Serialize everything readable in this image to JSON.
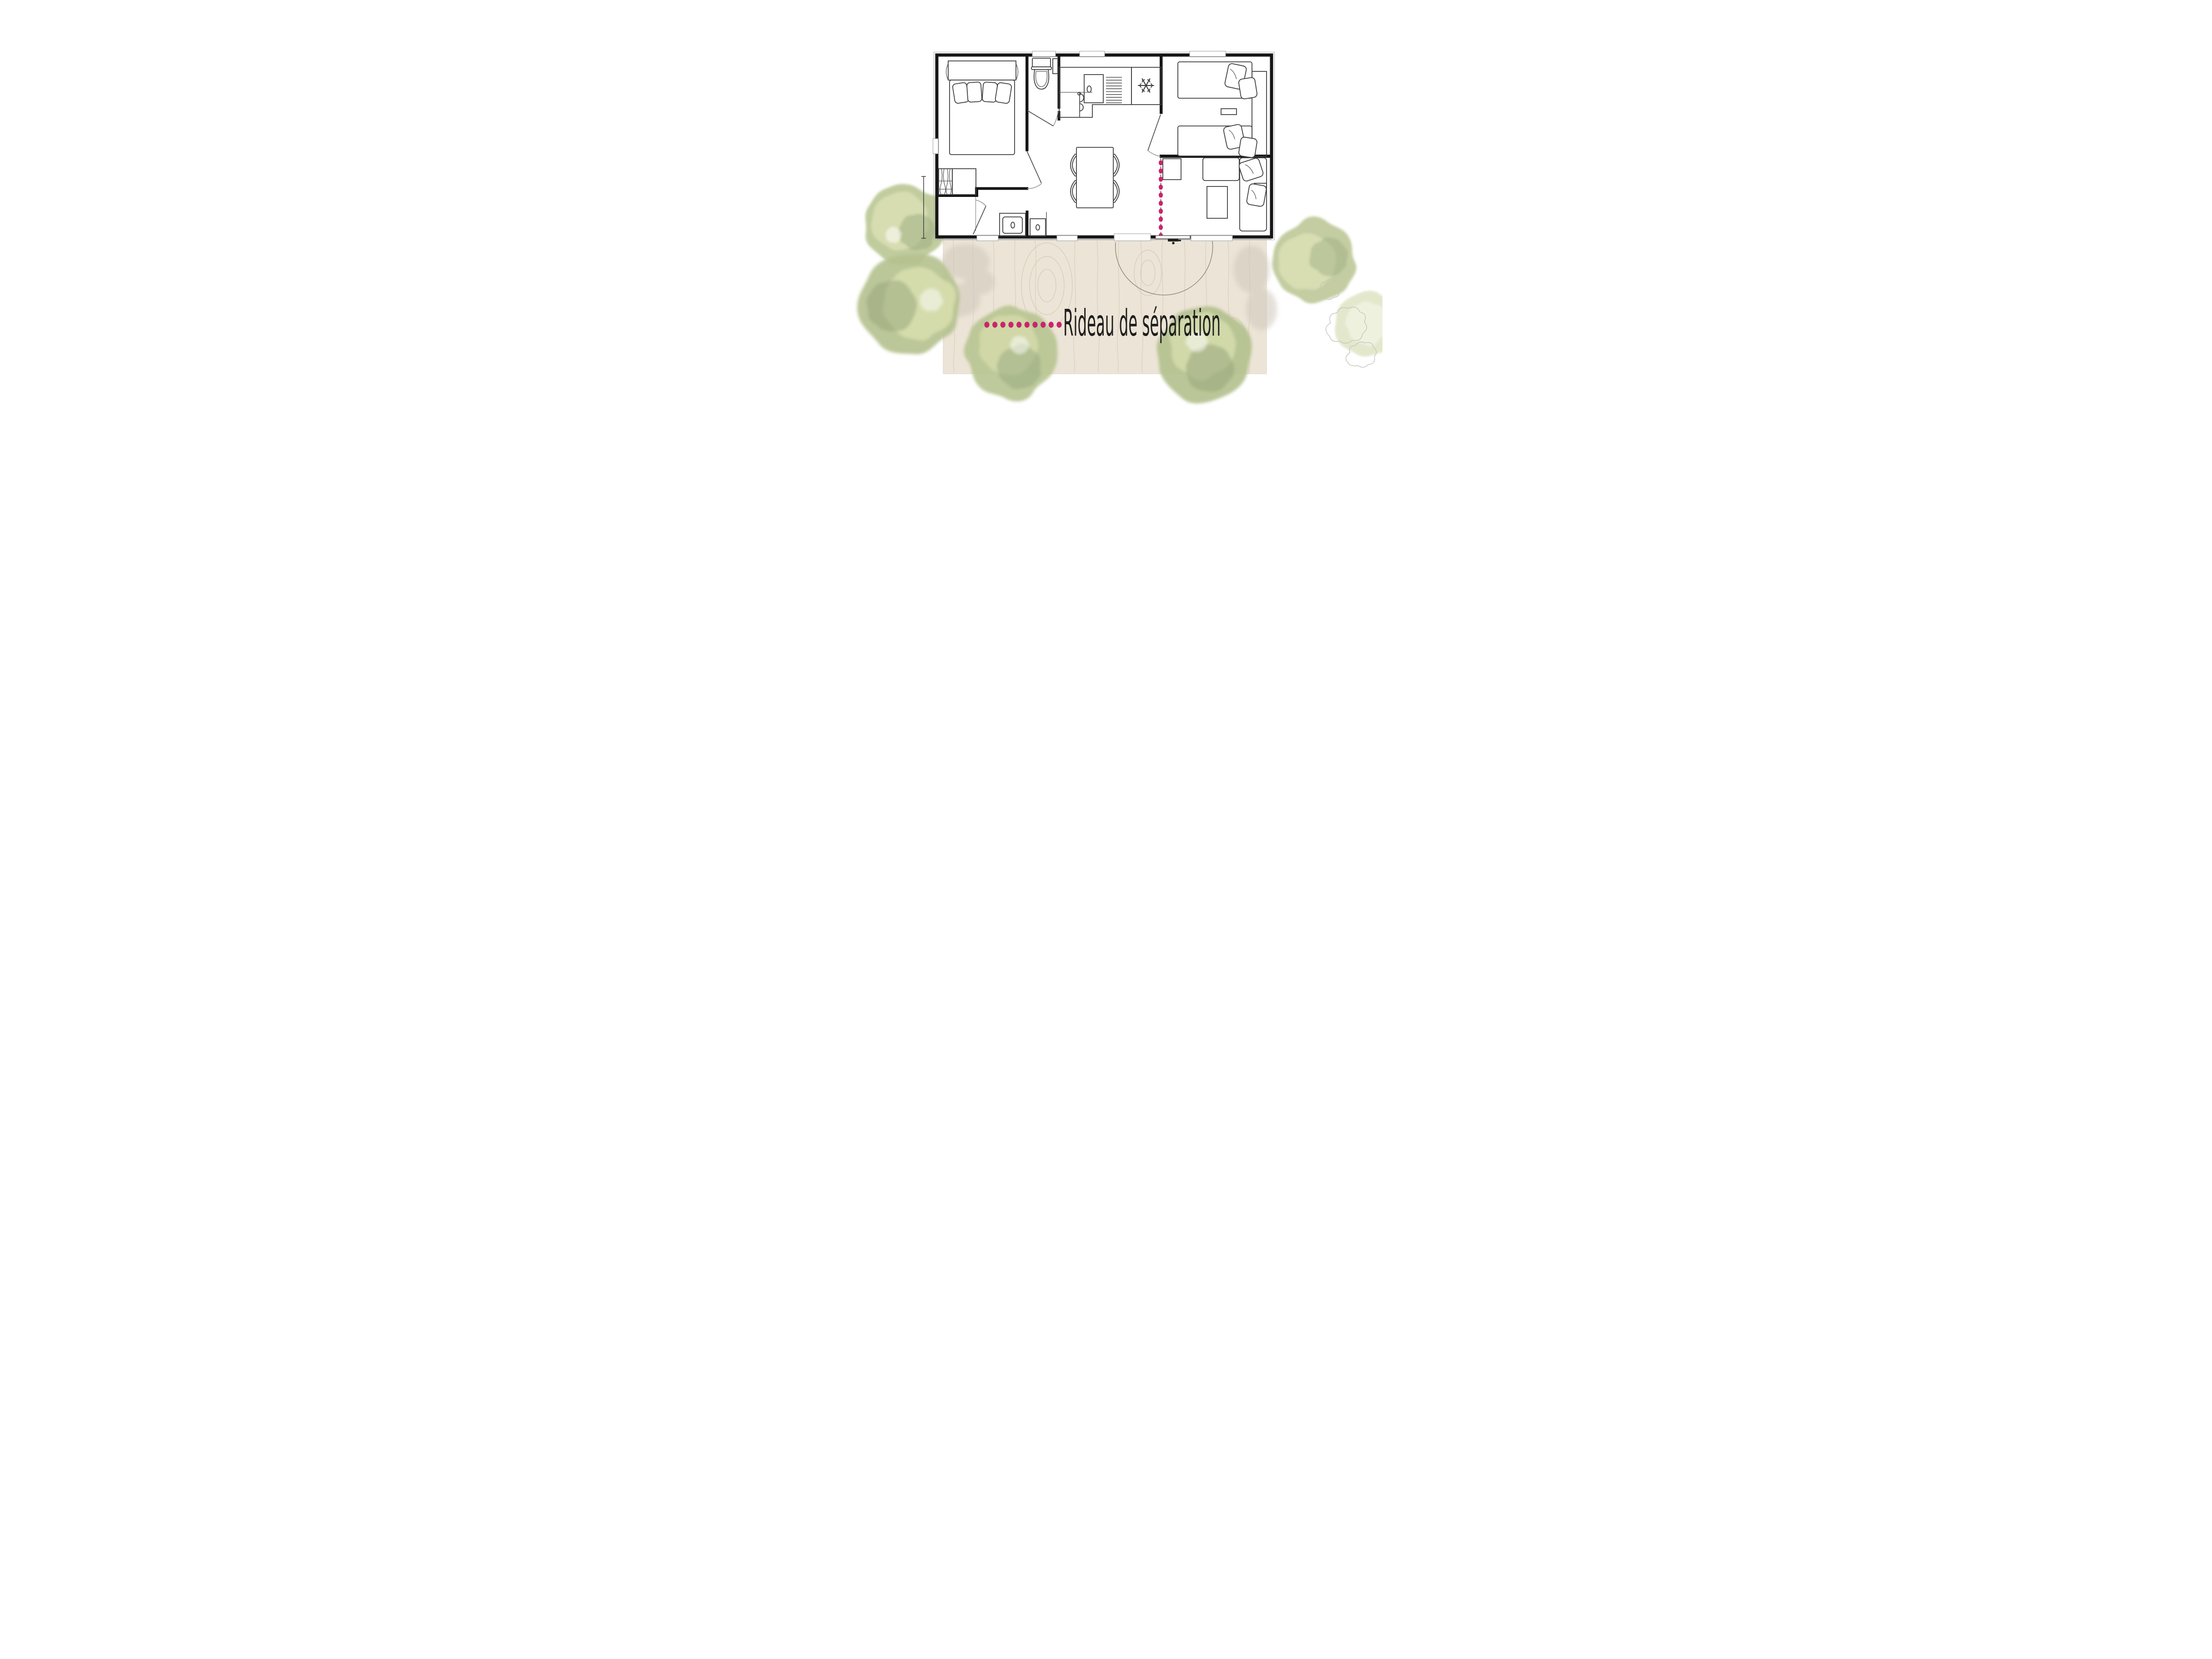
{
  "image_type": "mobile-home floor plan with terrace",
  "legend": {
    "label": "Rideau de séparation",
    "dot_color": "#c9256b",
    "dot_count": 10
  },
  "curtain": {
    "style": "dotted-line",
    "dot_color": "#c9256b",
    "dot_count": 10
  },
  "icons": {
    "fridge": "snowflake-icon",
    "curtain": "dotted-line-icon"
  },
  "colors": {
    "wall": "#161616",
    "furniture_line": "#4b4b4b",
    "deck": "#ece4d6",
    "deck_grain": "#d5cab7",
    "deck_shadow": "#cfc7bb",
    "tree_light": "#dce1b4",
    "tree_mid": "#bac794",
    "tree_dark": "#9aab80",
    "accent_pink": "#c9256b",
    "text": "#1e1e1e"
  }
}
